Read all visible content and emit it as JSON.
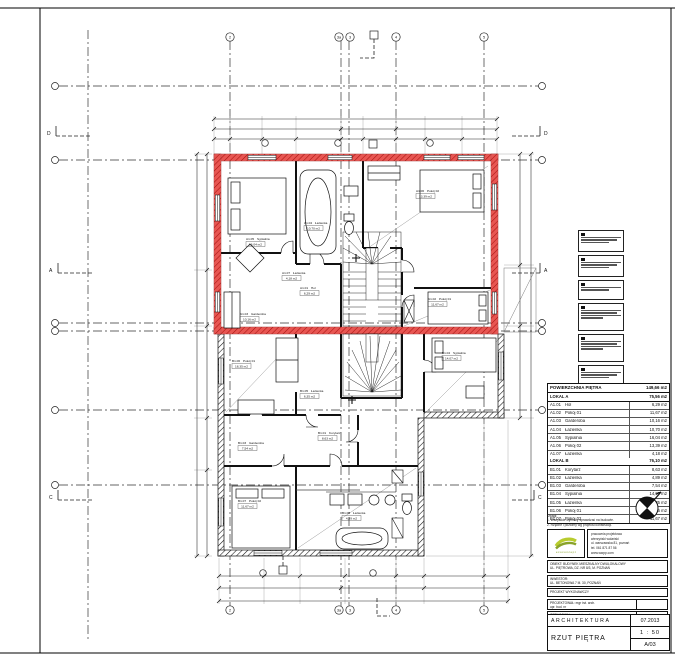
{
  "drawing": {
    "red_color": "#e0140f",
    "grid_top_labels": [
      "2",
      "3a",
      "3",
      "4",
      "5"
    ],
    "section_labels": {
      "left": [
        "D",
        "A",
        "C"
      ],
      "right": [
        "D",
        "A",
        "C"
      ]
    }
  },
  "table": {
    "header": "POWIERZCHNIA PIĘTRA",
    "header_value": "149,66 m2",
    "lokal_a": {
      "label": "LOKAL A",
      "value": "75,56 m2",
      "rows": [
        {
          "id": "A1.01",
          "name": "Hol",
          "area": "6,29 m2"
        },
        {
          "id": "A1.02",
          "name": "Pokój 01",
          "area": "11,67 m2"
        },
        {
          "id": "A1.03",
          "name": "Garderoba",
          "area": "10,16 m2"
        },
        {
          "id": "A1.04",
          "name": "Łazienka",
          "area": "10,70 m2"
        },
        {
          "id": "A1.05",
          "name": "Sypialnia",
          "area": "16,04 m2"
        },
        {
          "id": "A1.06",
          "name": "Pokój 02",
          "area": "13,39 m2"
        },
        {
          "id": "A1.07",
          "name": "Łazienka",
          "area": "4,18 m2"
        }
      ]
    },
    "lokal_b": {
      "label": "LOKAL B",
      "value": "76,10 m2",
      "rows": [
        {
          "id": "B1.01",
          "name": "Korytarz",
          "area": "8,63 m2"
        },
        {
          "id": "B1.02",
          "name": "Łazienka",
          "area": "4,89 m2"
        },
        {
          "id": "B1.03",
          "name": "Garderoba",
          "area": "7,54 m2"
        },
        {
          "id": "B1.04",
          "name": "Sypialnia",
          "area": "14,07 m2"
        },
        {
          "id": "B1.05",
          "name": "Łazienka",
          "area": "6,35 m2"
        },
        {
          "id": "B1.06",
          "name": "Pokój 01",
          "area": "18,35 m2"
        },
        {
          "id": "B1.07",
          "name": "Pokój 02",
          "area": "11,67 m2"
        }
      ]
    }
  },
  "titleblock": {
    "notes": {
      "l1": "Uwagi:",
      "l2": "1. Wszystkie wymiary sprawdzać na budowie.",
      "l3": "2. Rzędne i poziomy wg projektu konstrukcji."
    },
    "company": {
      "l1": "pracownia projektowa",
      "l2": "wierzyński wolański",
      "l3": "ul. warszawska 81, poznań",
      "l4": "tel. 061 871 87 56",
      "l5": "www.wwpp.com",
      "logo": "ecoconcept"
    },
    "rows": [
      {
        "l1": "OBIEKT: BUDYNEK MIESZKALNY DWULOKALOWY",
        "l2": "UL. PIĘTROWA, DZ. NR 8/3, M. POZNAŃ"
      },
      {
        "l1": "INWESTOR:",
        "l2": "UL. BETONOWA 7 M. 30, POZNAŃ"
      },
      {
        "l1": "PROJEKT WYKONAWCZY"
      },
      {
        "l1": "PROJEKTOWAŁ: mgr inż. arch.",
        "l2": "upr. bud. nr"
      },
      {
        "l1": "OPRACOWAŁ: mgr inż. arch."
      },
      {
        "l1": "SPRAWDZIŁ: mgr inż. arch.",
        "l2": "upr. bud. nr"
      }
    ],
    "discipline": "ARCHITEKTURA",
    "date": "07.2013",
    "title": "RZUT PIĘTRA",
    "scale": "1 : 50",
    "number": "A/03"
  }
}
